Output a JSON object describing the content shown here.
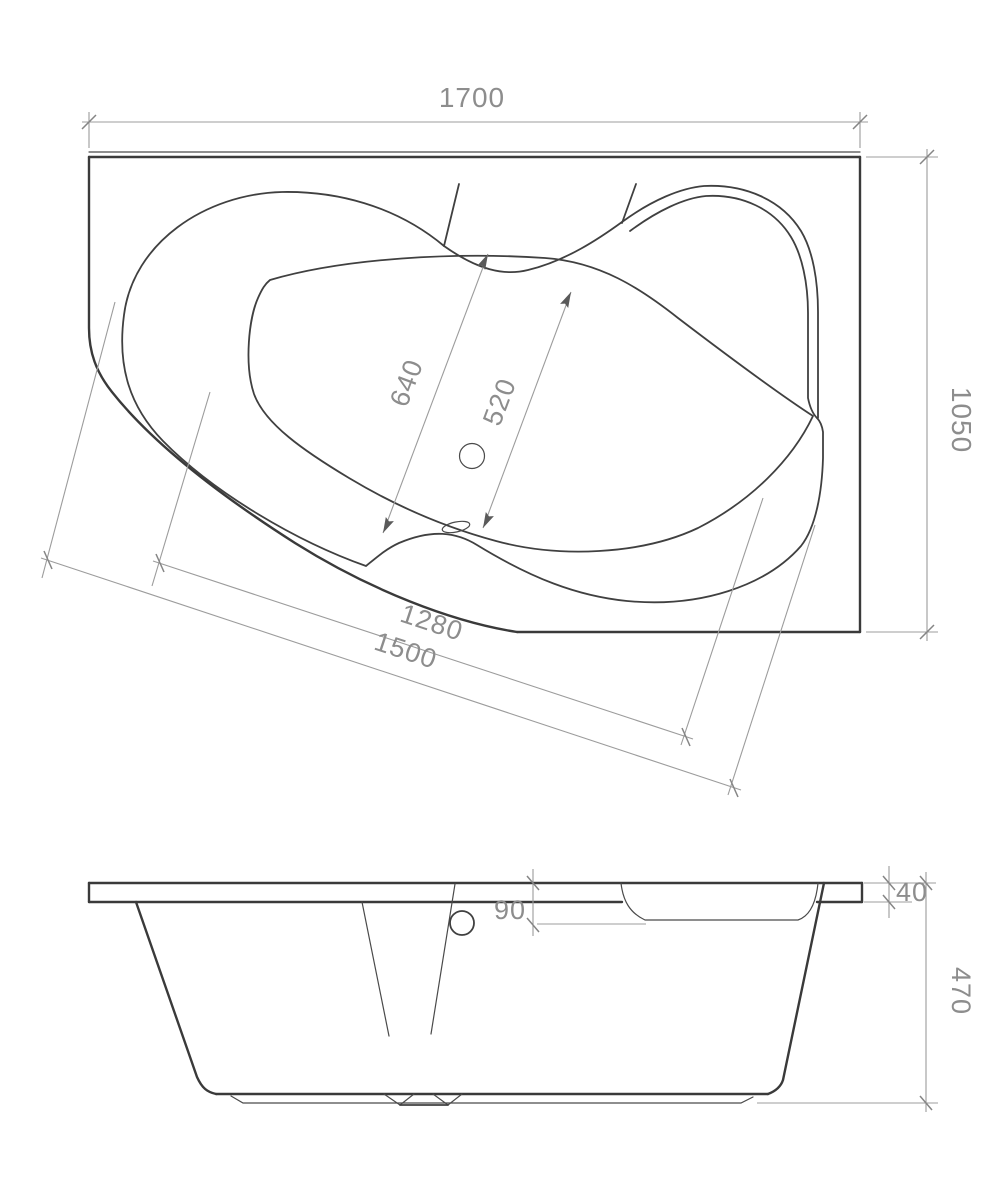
{
  "plan": {
    "dim_overall_length": "1700",
    "dim_overall_width": "1050",
    "dim_basin_length": "640",
    "dim_basin_width": "520",
    "dim_front_inner": "1280",
    "dim_front_outer": "1500"
  },
  "elevation": {
    "dim_rim_thickness": "40",
    "dim_overflow_offset": "90",
    "dim_body_height": "470"
  },
  "colors": {
    "background": "#ffffff",
    "outline": "#3a3a3a",
    "dimension_line": "#9c9c9c",
    "dimension_text": "#8d8d8d"
  }
}
